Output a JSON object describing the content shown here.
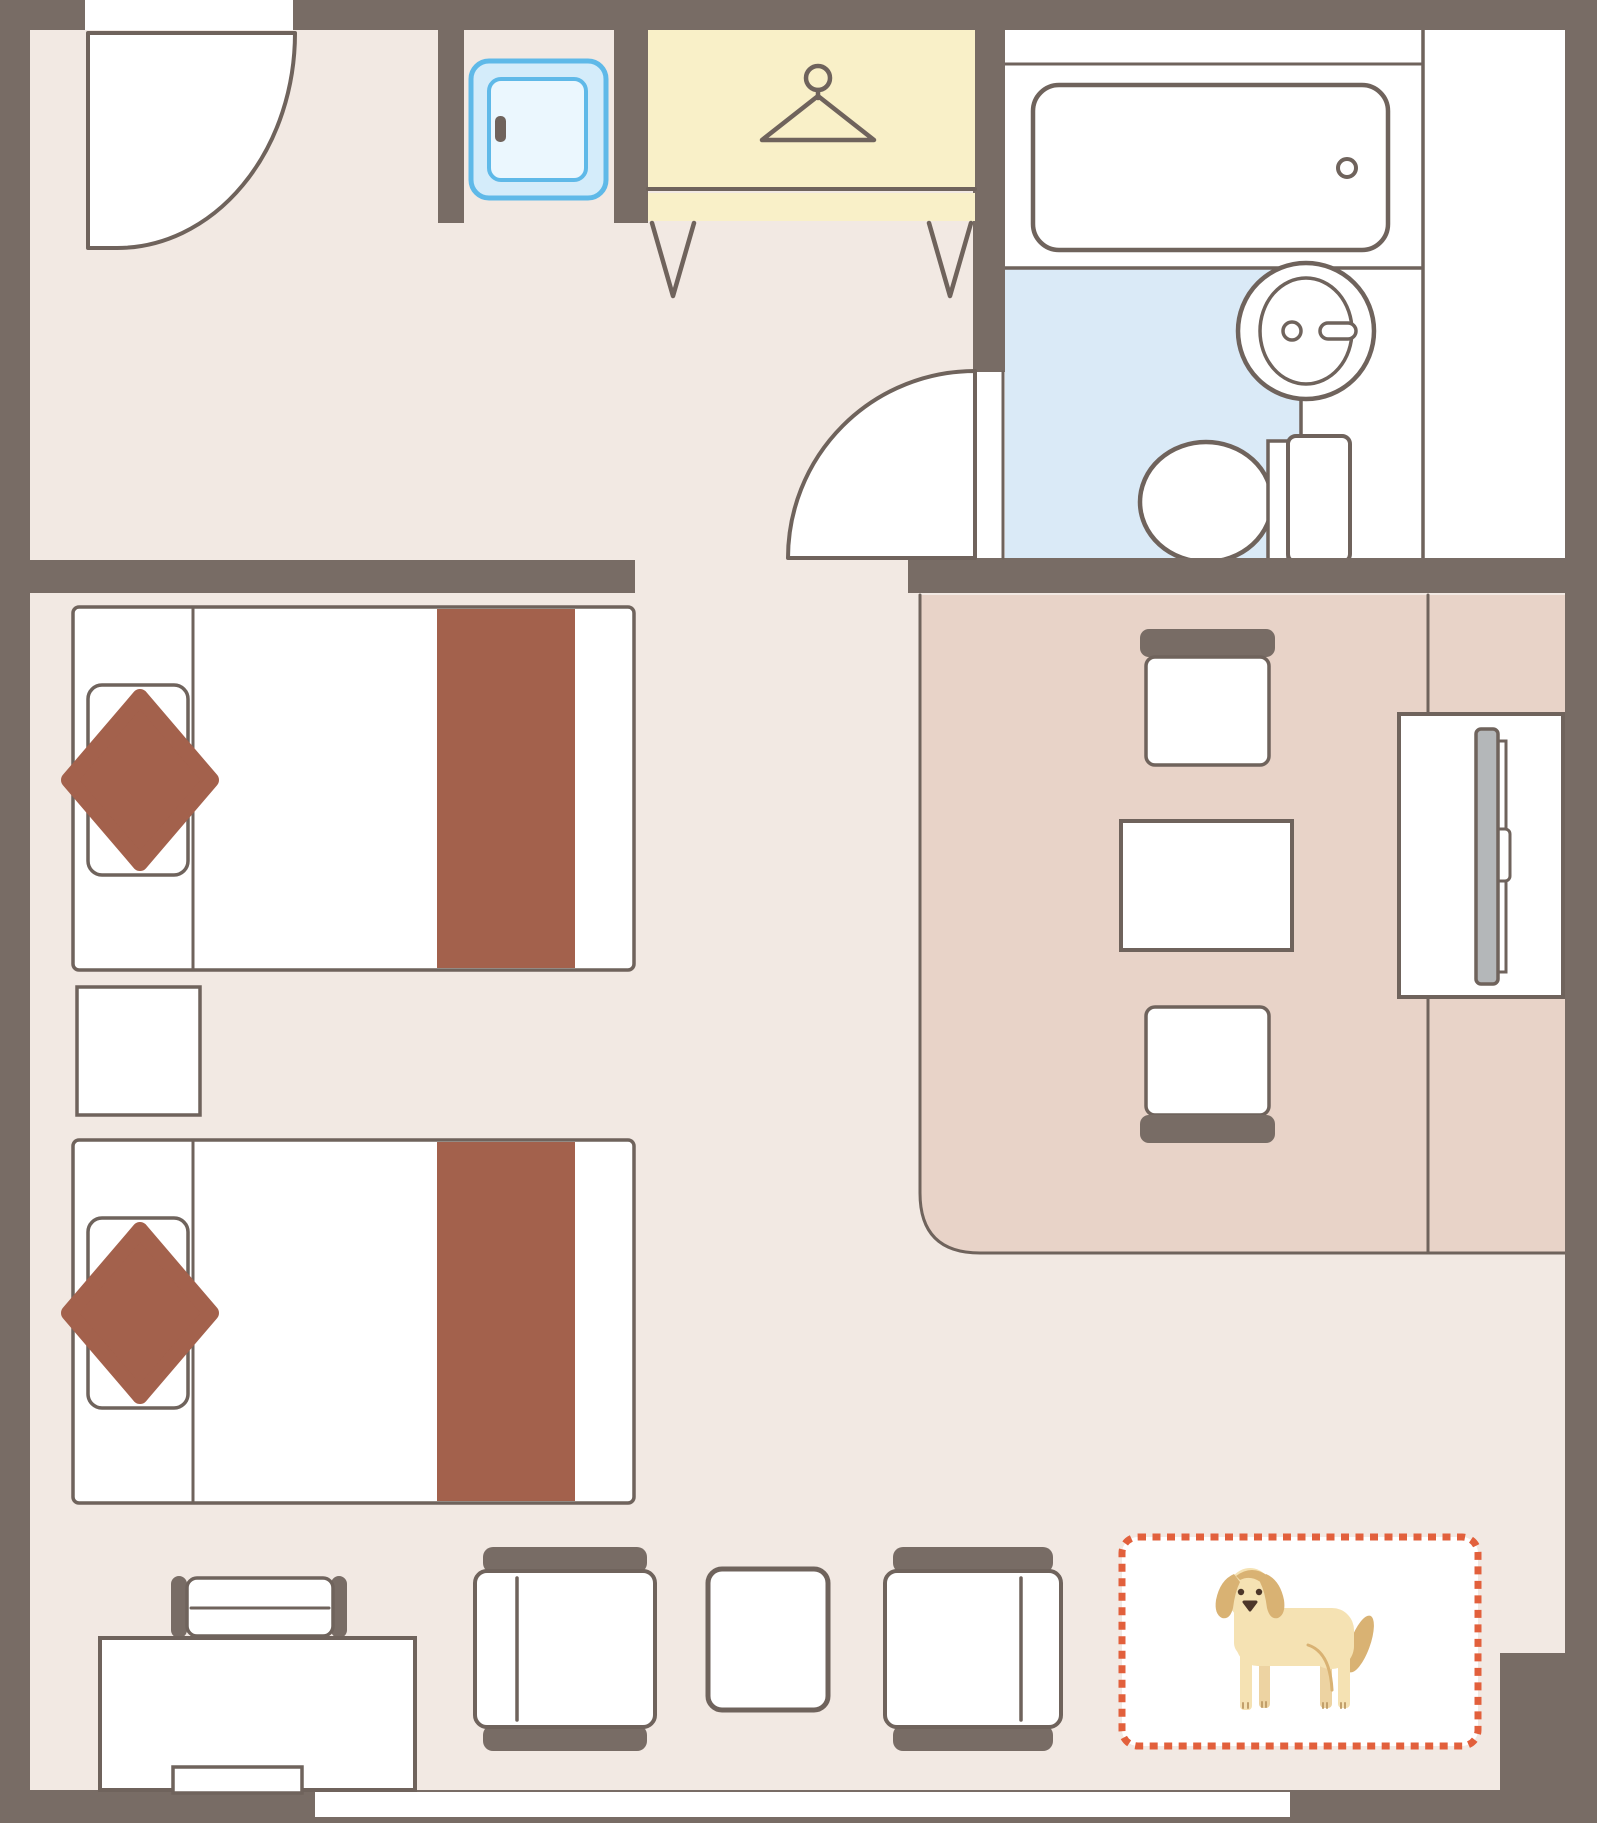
{
  "title": "Pet-friendly twin hotel room floor plan",
  "colors": {
    "wall": "#786C65",
    "line": "#6F635C",
    "floor": "#F2E9E3",
    "pink": "#E8D3C8",
    "bluefloor": "#DAEAF7",
    "yellow": "#F9F0C8",
    "brown": "#A3614C",
    "tvgray": "#B4B7B9",
    "orange": "#E2603C",
    "fridgeborder": "#5FB9E8",
    "fridgefill": "#D4ECFA",
    "fridgeinner": "#EBF7FE",
    "dogcream": "#F5E2B3",
    "dogtan": "#D9B273",
    "dogdark": "#4C3629",
    "dogshade": "#EDD3A2",
    "dogpaw": "#C2A06B",
    "white": "#FFFFFF"
  },
  "rooms": {
    "entry": "entry hall",
    "bedroom": "twin bedroom",
    "living": "living / dining corner",
    "bathroom": "bathroom",
    "pet_space": "dog space"
  },
  "furniture": [
    "entrance-door",
    "refrigerator",
    "luggage-rack",
    "hanger",
    "bathtub",
    "washbasin",
    "toilet",
    "bathroom-door",
    "twin-bed-1",
    "twin-bed-2",
    "nightstand",
    "dining-chair-top",
    "dining-table",
    "dining-chair-bottom",
    "tv-board",
    "tv",
    "desk",
    "desk-chair",
    "lounge-chair-left",
    "side-table",
    "lounge-chair-right",
    "dog-space",
    "dog",
    "window"
  ]
}
